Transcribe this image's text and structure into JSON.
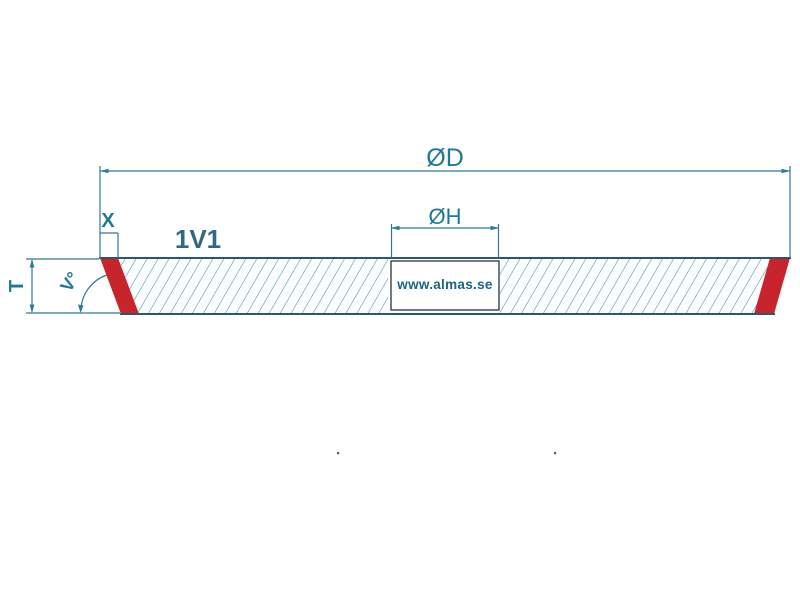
{
  "diagram": {
    "wheel_type_label": "1V1",
    "watermark": "www.almas.se",
    "dimensions": {
      "outer_diameter": "ØD",
      "bore_diameter": "ØH",
      "abrasive_depth": "X",
      "thickness": "T",
      "face_angle": "V°"
    },
    "colors": {
      "dimension_line": "#2d7b95",
      "dimension_text": "#1e7a94",
      "wheel_type_text": "#306a80",
      "watermark_text": "#1a657f",
      "outline": "#2a5866",
      "hatch": "#4d8395",
      "abrasive_rim": "#c8242c",
      "bore_border": "#28343a",
      "wheel_fill": "#fafdfd",
      "background": "#ffffff",
      "speck": "#3f3f3f"
    }
  }
}
